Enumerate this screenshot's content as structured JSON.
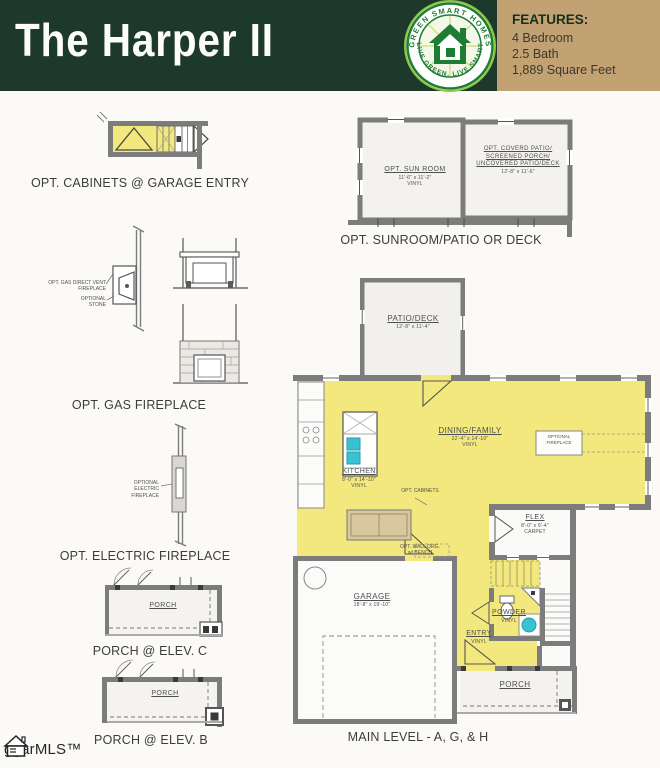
{
  "header": {
    "title": "The Harper II",
    "logo": {
      "arc_top": "GREEN SMART HOMES",
      "arc_bottom": "LIVE GREEN. LIVE SMART"
    },
    "features": {
      "heading": "FEATURES:",
      "items": [
        "4 Bedroom",
        "2.5 Bath",
        "1,889 Square Feet"
      ]
    }
  },
  "details": {
    "cabinets_garage": {
      "caption": "OPT. CABINETS @ GARAGE ENTRY"
    },
    "sunroom": {
      "caption": "OPT. SUNROOM/PATIO OR DECK",
      "sun_room": {
        "name": "OPT. SUN ROOM",
        "dims": "11'-6\" x 11'-2\"",
        "floor": "VINYL"
      },
      "covered_patio": {
        "name_lines": [
          "OPT. COVERD PATIO/",
          "SCREENED PORCH/",
          "UNCOVERED PATIO/DECK"
        ],
        "dims": "12'-8\" x 11'-6\""
      }
    },
    "gas_fireplace": {
      "caption": "OPT. GAS FIREPLACE",
      "vent_note_lines": [
        "OPT. GAS DIRECT VENT",
        "FIREPLACE"
      ],
      "stone_note_lines": [
        "OPTIONAL",
        "STONE"
      ]
    },
    "electric_fireplace": {
      "caption": "OPT. ELECTRIC FIREPLACE",
      "note_lines": [
        "OPTIONAL",
        "ELECTRIC",
        "FIREPLACE"
      ]
    },
    "porch_c": {
      "caption": "PORCH @ ELEV. C",
      "room": "PORCH"
    },
    "porch_b": {
      "caption": "PORCH @ ELEV. B",
      "room": "PORCH"
    }
  },
  "main_level": {
    "caption": "MAIN LEVEL - A, G, & H",
    "patio_deck": {
      "name": "PATIO/DECK",
      "dims": "12'-8\" x 11'-4\""
    },
    "dining_family": {
      "name": "DINING/FAMILY",
      "dims": "22'-4\" x 14'-10\"",
      "floor": "VINYL"
    },
    "kitchen": {
      "name": "KITCHEN",
      "dims": "8'-0\" x 14'-10\"",
      "floor": "VINYL"
    },
    "flex": {
      "name": "FLEX",
      "dims": "8'-0\" x 9'-4\"",
      "floor": "CARPET"
    },
    "powder": {
      "name": "POWDER",
      "floor": "VINYL"
    },
    "entry": {
      "name": "ENTRY",
      "floor": "VINYL"
    },
    "garage": {
      "name": "GARAGE",
      "dims": "18'-8\" x 19'-10\""
    },
    "porch": {
      "name": "PORCH"
    },
    "notes": {
      "opt_cabinets": "OPT. CABINETS",
      "wall_org_lines": [
        "OPT. WALL ORG.",
        "w/ BENCH"
      ],
      "fireplace_box_lines": [
        "OPTIONAL",
        "FIREPLACE"
      ]
    }
  },
  "watermark": "ggarMLS™",
  "colors": {
    "header_green": "#1d392b",
    "features_tan": "#c2a272",
    "plan_yellow": "#f2e87d",
    "wall_gray": "#7c7c7c",
    "fixture_cyan": "#39c2d4",
    "logo_green": "#1e7c33"
  }
}
